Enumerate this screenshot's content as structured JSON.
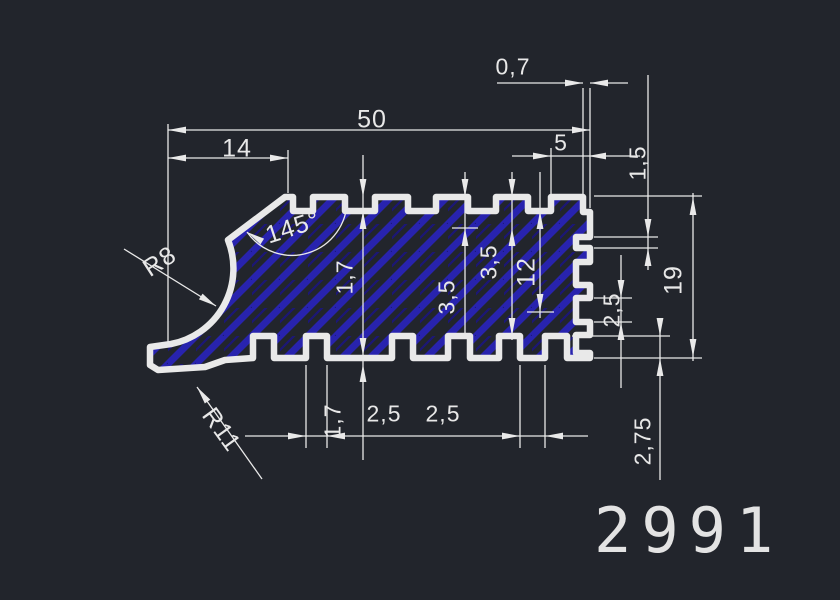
{
  "app": {
    "type": "cad-drawing-viewer"
  },
  "drawing": {
    "part_number": "2991",
    "colors": {
      "background": "#22252c",
      "line": "#e9e9e9",
      "hatch_primary": "#2823ae",
      "hatch_secondary": "#1b1677"
    },
    "annotations": {
      "dim_width_total": "50",
      "dim_width_chamfer": "14",
      "dim_lip_0_7": "0,7",
      "dim_top_right_5": "5",
      "dim_right_slot_1_5": "1,5",
      "dim_height_19": "19",
      "dim_right_slot_2_5": "2,5",
      "dim_bottom_slot_2_75": "2,75",
      "angle_chamfer": "145°",
      "radius_cove": "R8",
      "radius_foot": "R11",
      "dim_tooth_depth_1_7": "1,7",
      "dim_3_5_a": "3,5",
      "dim_3_5_b": "3,5",
      "dim_core_12": "12",
      "dim_bottom_1_7": "1,7",
      "dim_bottom_2_5_a": "2,5",
      "dim_bottom_2_5_b": "2,5"
    }
  }
}
